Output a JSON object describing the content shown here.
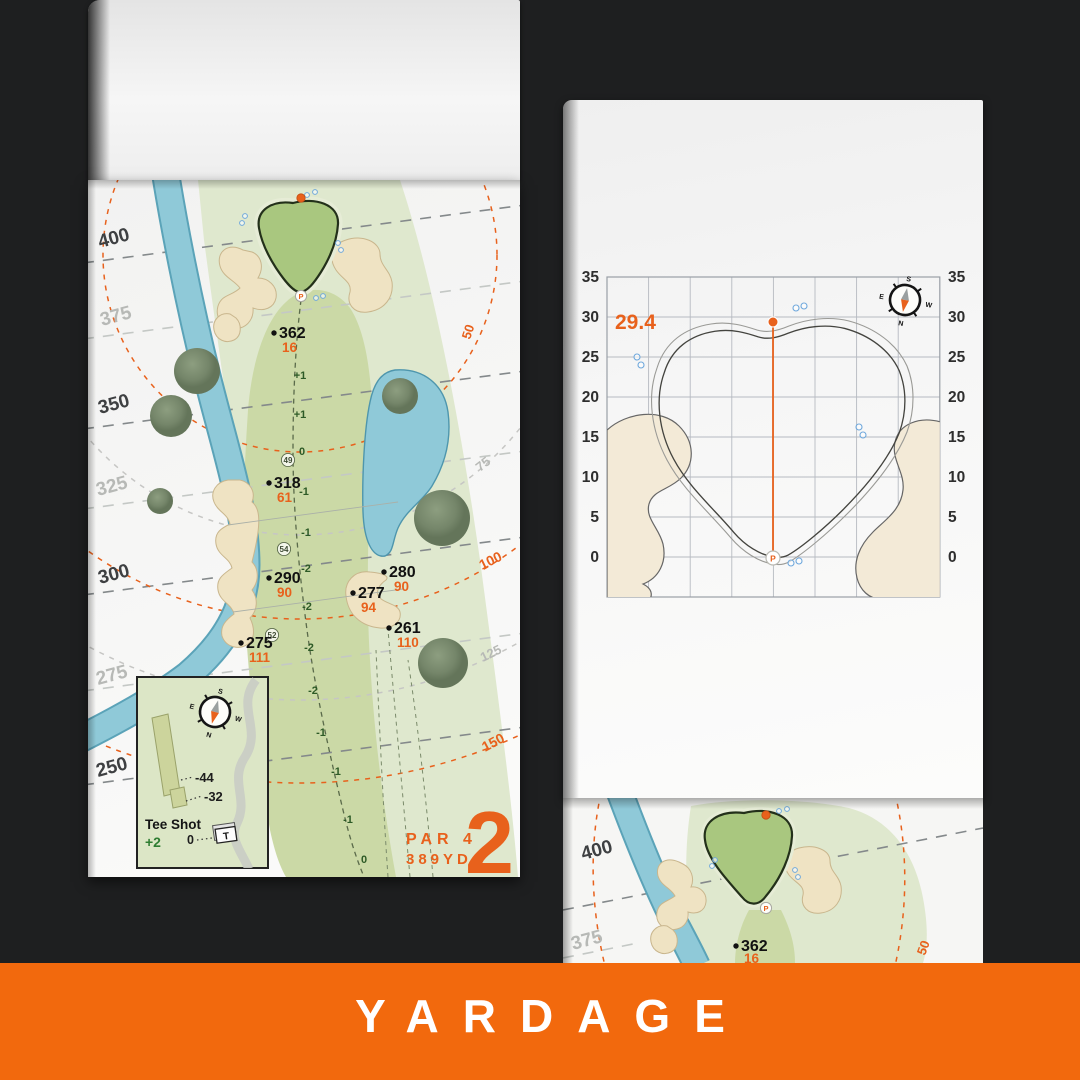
{
  "banner": {
    "label": "YARDAGE"
  },
  "compass": {
    "n": "N",
    "s": "S",
    "e": "E",
    "w": "W"
  },
  "hole": {
    "number": "2",
    "par": "PAR 4",
    "yards": "389YD",
    "lines": [
      "400",
      "375",
      "350",
      "325",
      "300",
      "275",
      "250"
    ],
    "arcs": [
      "50",
      "75",
      "100",
      "125",
      "150"
    ],
    "markers": [
      {
        "d": "362",
        "c": "16"
      },
      {
        "d": "318",
        "c": "61"
      },
      {
        "d": "290",
        "c": "90"
      },
      {
        "d": "280",
        "c": "90"
      },
      {
        "d": "277",
        "c": "94"
      },
      {
        "d": "261",
        "c": "110"
      },
      {
        "d": "275",
        "c": "111"
      }
    ],
    "elev": [
      "+1",
      "+1",
      "0",
      "-1",
      "-1",
      "-2",
      "-2",
      "-2",
      "-2",
      "-1",
      "-1",
      "-1",
      "0"
    ],
    "widths": [
      "49",
      "54",
      "52"
    ],
    "pin": "P",
    "tee": {
      "title": "Tee Shot",
      "elev": "+2",
      "zero": "0",
      "left": "-44",
      "right": "-32",
      "marker": "T"
    }
  },
  "green": {
    "depth": "29.4",
    "ticks": [
      "35",
      "30",
      "25",
      "20",
      "15",
      "10",
      "5",
      "0"
    ],
    "pin": "P"
  },
  "next": {
    "lines": [
      "400",
      "375"
    ],
    "arc": "50",
    "marker": {
      "d": "362",
      "c": "16"
    },
    "pin": "P"
  },
  "colors": {
    "accent_orange": "#E8611C",
    "banner_orange": "#F2690D",
    "water_blue": "#8FC9D8",
    "fairway_green": "#CBD9A6",
    "rough_green": "#DFE8CE",
    "putting_green": "#A9C77F",
    "bunker_sand": "#EFE3C3",
    "elevation_green": "#2D5A26"
  },
  "chart_data": {
    "type": "scatter",
    "title": "Green depth grid - hole 2",
    "ylabel": "Yards from front of green",
    "yticks": [
      35,
      30,
      25,
      20,
      15,
      10,
      5,
      0
    ],
    "ylim": [
      -5,
      35
    ],
    "grid": true,
    "points": [
      {
        "label": "pin",
        "y": 29.4
      },
      {
        "label": "front-of-green P",
        "y": 0
      }
    ],
    "annotations": [
      "29.4"
    ]
  }
}
